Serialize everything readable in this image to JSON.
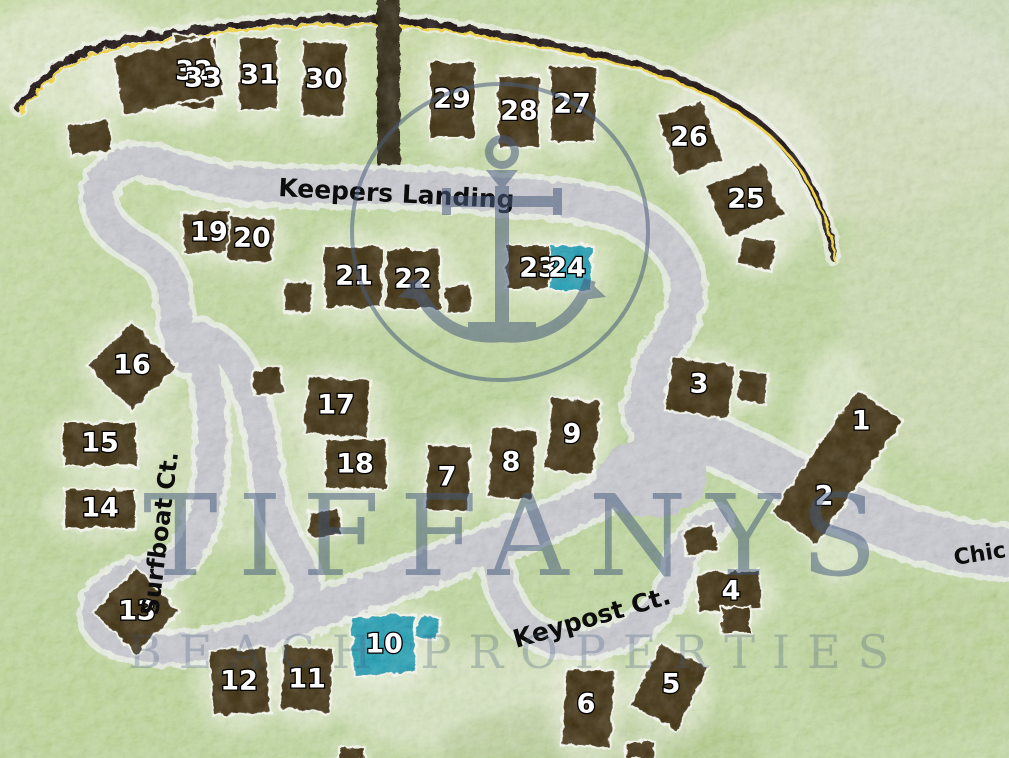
{
  "map": {
    "watermark": {
      "line1": "TIFFANYS",
      "line2": "BEACH PROPERTIES",
      "logo": "anchor-in-circle"
    },
    "streets": [
      {
        "id": "keepers-landing",
        "label": "Keepers Landing",
        "x": 278,
        "y": 196,
        "rotate": 3,
        "size": 25
      },
      {
        "id": "surfboat-ct",
        "label": "Surfboat Ct.",
        "x": 158,
        "y": 616,
        "rotate": -83,
        "size": 24
      },
      {
        "id": "keypost-ct",
        "label": "Keypost Ct.",
        "x": 516,
        "y": 648,
        "rotate": -16,
        "size": 25
      },
      {
        "id": "chic-partial",
        "label": "Chic",
        "x": 955,
        "y": 565,
        "rotate": -9,
        "size": 22
      }
    ],
    "colors": {
      "terrain_green": "#a9c77d",
      "road_gray": "#b5b6be",
      "road_halo": "#eef0f2",
      "house_brown": "#332709",
      "pool_teal": "#1e7e99",
      "highway_black": "#14100a",
      "centerline_yellow": "#edc52f",
      "watermark_blue": "#41577a",
      "lot_number_white": "#ffffff",
      "street_text_black": "#0d0d0d"
    },
    "lots": [
      {
        "n": "1",
        "lx": 861,
        "ly": 421,
        "cx": 837,
        "cy": 467,
        "w": 56,
        "h": 150,
        "rot": 35,
        "kind": "house"
      },
      {
        "n": "2",
        "lx": 824,
        "ly": 496,
        "kind": "label-only"
      },
      {
        "n": "3",
        "lx": 699,
        "ly": 384,
        "cx": 700,
        "cy": 388,
        "w": 64,
        "h": 54,
        "rot": 8,
        "kind": "house"
      },
      {
        "n": "4",
        "lx": 731,
        "ly": 591,
        "cx": 729,
        "cy": 591,
        "w": 64,
        "h": 40,
        "rot": -4,
        "kind": "house"
      },
      {
        "n": "5",
        "lx": 671,
        "ly": 684,
        "cx": 669,
        "cy": 687,
        "w": 54,
        "h": 70,
        "rot": 28,
        "kind": "house"
      },
      {
        "n": "6",
        "lx": 586,
        "ly": 704,
        "cx": 588,
        "cy": 708,
        "w": 50,
        "h": 78,
        "rot": 4,
        "kind": "house"
      },
      {
        "n": "7",
        "lx": 447,
        "ly": 477,
        "cx": 448,
        "cy": 478,
        "w": 44,
        "h": 66,
        "rot": 2,
        "kind": "house"
      },
      {
        "n": "8",
        "lx": 511,
        "ly": 462,
        "cx": 512,
        "cy": 464,
        "w": 46,
        "h": 70,
        "rot": 4,
        "kind": "house"
      },
      {
        "n": "9",
        "lx": 572,
        "ly": 434,
        "cx": 573,
        "cy": 436,
        "w": 50,
        "h": 74,
        "rot": 6,
        "kind": "house"
      },
      {
        "n": "10",
        "lx": 384,
        "ly": 644,
        "cx": 384,
        "cy": 645,
        "w": 64,
        "h": 60,
        "rot": -3,
        "kind": "pool"
      },
      {
        "n": "11",
        "lx": 307,
        "ly": 679,
        "cx": 307,
        "cy": 679,
        "w": 50,
        "h": 64,
        "rot": 4,
        "kind": "house"
      },
      {
        "n": "12",
        "lx": 239,
        "ly": 681,
        "cx": 240,
        "cy": 681,
        "w": 58,
        "h": 66,
        "rot": -4,
        "kind": "house"
      },
      {
        "n": "13",
        "lx": 137,
        "ly": 611,
        "cx": 136,
        "cy": 611,
        "w": 62,
        "h": 62,
        "rot": 45,
        "kind": "house"
      },
      {
        "n": "14",
        "lx": 100,
        "ly": 508,
        "cx": 100,
        "cy": 509,
        "w": 72,
        "h": 40,
        "rot": 0,
        "kind": "house"
      },
      {
        "n": "15",
        "lx": 100,
        "ly": 443,
        "cx": 100,
        "cy": 444,
        "w": 74,
        "h": 44,
        "rot": 0,
        "kind": "house"
      },
      {
        "n": "16",
        "lx": 132,
        "ly": 365,
        "cx": 132,
        "cy": 366,
        "w": 64,
        "h": 64,
        "rot": 45,
        "kind": "house"
      },
      {
        "n": "17",
        "lx": 336,
        "ly": 405,
        "cx": 337,
        "cy": 407,
        "w": 64,
        "h": 58,
        "rot": 4,
        "kind": "house"
      },
      {
        "n": "18",
        "lx": 355,
        "ly": 464,
        "cx": 356,
        "cy": 464,
        "w": 62,
        "h": 50,
        "rot": 0,
        "kind": "house"
      },
      {
        "n": "19",
        "lx": 209,
        "ly": 232,
        "cx": 207,
        "cy": 232,
        "w": 50,
        "h": 42,
        "rot": -3,
        "kind": "house"
      },
      {
        "n": "20",
        "lx": 252,
        "ly": 238,
        "cx": 251,
        "cy": 239,
        "w": 46,
        "h": 44,
        "rot": 2,
        "kind": "house"
      },
      {
        "n": "21",
        "lx": 354,
        "ly": 276,
        "cx": 353,
        "cy": 277,
        "w": 58,
        "h": 62,
        "rot": 0,
        "kind": "house"
      },
      {
        "n": "22",
        "lx": 413,
        "ly": 279,
        "cx": 413,
        "cy": 279,
        "w": 55,
        "h": 60,
        "rot": 0,
        "kind": "house"
      },
      {
        "n": "23",
        "lx": 538,
        "ly": 268,
        "cx": 531,
        "cy": 267,
        "w": 50,
        "h": 44,
        "rot": 0,
        "kind": "house"
      },
      {
        "n": "24",
        "lx": 567,
        "ly": 268,
        "cx": 571,
        "cy": 268,
        "w": 42,
        "h": 46,
        "rot": 0,
        "kind": "pool"
      },
      {
        "n": "25",
        "lx": 746,
        "ly": 199,
        "cx": 745,
        "cy": 200,
        "w": 62,
        "h": 56,
        "rot": -22,
        "kind": "house"
      },
      {
        "n": "26",
        "lx": 689,
        "ly": 137,
        "cx": 690,
        "cy": 138,
        "w": 48,
        "h": 64,
        "rot": -18,
        "kind": "house"
      },
      {
        "n": "27",
        "lx": 572,
        "ly": 104,
        "cx": 573,
        "cy": 104,
        "w": 46,
        "h": 76,
        "rot": 0,
        "kind": "house"
      },
      {
        "n": "28",
        "lx": 519,
        "ly": 111,
        "cx": 519,
        "cy": 112,
        "w": 42,
        "h": 72,
        "rot": 0,
        "kind": "house"
      },
      {
        "n": "29",
        "lx": 452,
        "ly": 99,
        "cx": 452,
        "cy": 100,
        "w": 46,
        "h": 78,
        "rot": 0,
        "kind": "house"
      },
      {
        "n": "30",
        "lx": 324,
        "ly": 79,
        "cx": 324,
        "cy": 79,
        "w": 44,
        "h": 74,
        "rot": 2,
        "kind": "house"
      },
      {
        "n": "31",
        "lx": 259,
        "ly": 75,
        "cx": 258,
        "cy": 74,
        "w": 40,
        "h": 72,
        "rot": 0,
        "kind": "house"
      },
      {
        "n": "32",
        "lx": 194,
        "ly": 71,
        "cx": 194,
        "cy": 72,
        "w": 42,
        "h": 72,
        "rot": 2,
        "kind": "house"
      },
      {
        "n": "33",
        "lx": 203,
        "ly": 78,
        "cx": 168,
        "cy": 76,
        "w": 102,
        "h": 60,
        "rot": -12,
        "kind": "house"
      }
    ],
    "structures": [
      {
        "cx": 90,
        "cy": 138,
        "w": 42,
        "h": 32,
        "rot": -8,
        "kind": "house"
      },
      {
        "cx": 757,
        "cy": 253,
        "w": 36,
        "h": 30,
        "rot": 12,
        "kind": "house"
      },
      {
        "cx": 298,
        "cy": 297,
        "w": 28,
        "h": 30,
        "rot": 4,
        "kind": "house"
      },
      {
        "cx": 458,
        "cy": 299,
        "w": 26,
        "h": 28,
        "rot": -6,
        "kind": "house"
      },
      {
        "cx": 268,
        "cy": 381,
        "w": 30,
        "h": 26,
        "rot": -8,
        "kind": "house"
      },
      {
        "cx": 325,
        "cy": 523,
        "w": 32,
        "h": 26,
        "rot": -4,
        "kind": "house"
      },
      {
        "cx": 753,
        "cy": 387,
        "w": 28,
        "h": 30,
        "rot": 6,
        "kind": "house"
      },
      {
        "cx": 700,
        "cy": 540,
        "w": 32,
        "h": 28,
        "rot": -10,
        "kind": "house"
      },
      {
        "cx": 736,
        "cy": 620,
        "w": 30,
        "h": 26,
        "rot": 0,
        "kind": "house"
      },
      {
        "cx": 428,
        "cy": 628,
        "w": 22,
        "h": 24,
        "rot": 8,
        "kind": "pool"
      },
      {
        "cx": 640,
        "cy": 750,
        "w": 30,
        "h": 18,
        "rot": 0,
        "kind": "house"
      },
      {
        "cx": 352,
        "cy": 754,
        "w": 26,
        "h": 14,
        "rot": 0,
        "kind": "house"
      }
    ]
  }
}
